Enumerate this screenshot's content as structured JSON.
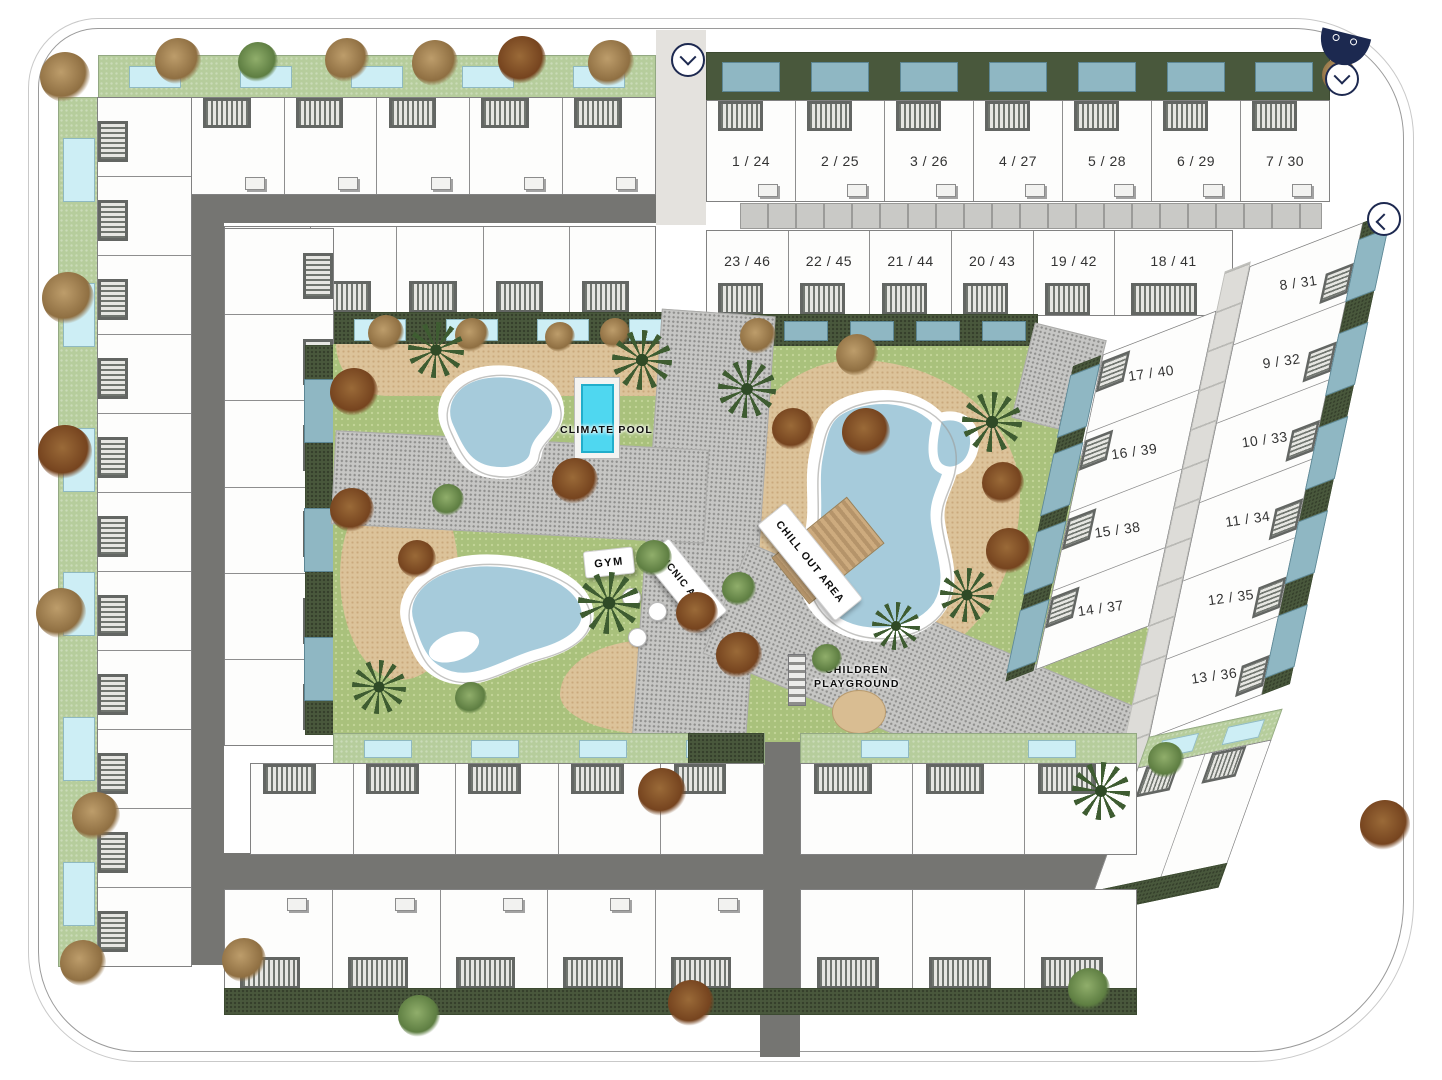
{
  "colors": {
    "navy": "#1d2950",
    "road": "#757572",
    "hedge_green": "#49583c",
    "lawn_green": "#b6cd9c",
    "amenity_grass": "#a9c17c",
    "sand": "#dcc39a",
    "lagoon_water": "#a6cbdb",
    "private_pool": "#cdeef5",
    "slate_pool": "#8fb7c3",
    "climate_pool": "#4fd7f0"
  },
  "units": {
    "row_top": [
      "1 / 24",
      "2 / 25",
      "3 / 26",
      "4 / 27",
      "5 / 28",
      "6 / 29",
      "7 / 30"
    ],
    "row_second": [
      "23 / 46",
      "22 / 45",
      "21 / 44",
      "20 / 43",
      "19 / 42",
      "18 / 41"
    ],
    "right_outer": [
      "8 / 31",
      "9 / 32",
      "10 / 33",
      "11 / 34",
      "12 / 35",
      "13 / 36"
    ],
    "right_inner": [
      "17 / 40",
      "16 / 39",
      "15 / 38",
      "14 / 37"
    ]
  },
  "labels": {
    "climate_pool": "CLIMATE POOL",
    "gym": "GYM",
    "picnic_area": "PICNIC AREA",
    "chill_out_area": "CHILL OUT AREA",
    "children_line1": "CHILDREN",
    "children_line2": "PLAYGROUND"
  },
  "plain_blocks": {
    "top_left_row1": 6,
    "top_left_row2": 5,
    "left_col_a": 11,
    "left_col_b": 6,
    "row_c_left": 5,
    "row_c_right": 3,
    "row_d_left": 5,
    "row_d_right": 3,
    "corner_cells": 2
  },
  "garden_pools": {
    "g1": 5,
    "g2": 7,
    "g3": 5,
    "left_strip": 6,
    "h1": 4,
    "hedge_b": 3,
    "g4_left": 4,
    "g4_right": 2,
    "diag_inner": 4,
    "diag_outer": 5,
    "corner": 2
  },
  "entrances": [
    {
      "dir": "down"
    },
    {
      "dir": "down"
    },
    {
      "dir": "left"
    }
  ],
  "decor": {
    "trees": [
      {
        "x": 155,
        "y": 38,
        "t": "t",
        "s": 46
      },
      {
        "x": 238,
        "y": 42,
        "t": "g",
        "s": 40
      },
      {
        "x": 325,
        "y": 38,
        "t": "t",
        "s": 44
      },
      {
        "x": 412,
        "y": 40,
        "t": "t",
        "s": 46
      },
      {
        "x": 498,
        "y": 36,
        "t": "r",
        "s": 48
      },
      {
        "x": 588,
        "y": 40,
        "t": "t",
        "s": 46
      },
      {
        "x": 40,
        "y": 52,
        "t": "t",
        "s": 50
      },
      {
        "x": 42,
        "y": 272,
        "t": "t",
        "s": 52
      },
      {
        "x": 38,
        "y": 425,
        "t": "r",
        "s": 54
      },
      {
        "x": 36,
        "y": 588,
        "t": "t",
        "s": 50
      },
      {
        "x": 72,
        "y": 792,
        "t": "t",
        "s": 48
      },
      {
        "x": 60,
        "y": 940,
        "t": "t",
        "s": 46
      },
      {
        "x": 368,
        "y": 315,
        "t": "t",
        "s": 36
      },
      {
        "x": 455,
        "y": 318,
        "t": "t",
        "s": 34
      },
      {
        "x": 545,
        "y": 322,
        "t": "t",
        "s": 30
      },
      {
        "x": 600,
        "y": 318,
        "t": "t",
        "s": 30
      },
      {
        "x": 740,
        "y": 318,
        "t": "t",
        "s": 36
      },
      {
        "x": 836,
        "y": 334,
        "t": "t",
        "s": 42
      },
      {
        "x": 330,
        "y": 368,
        "t": "r",
        "s": 48
      },
      {
        "x": 408,
        "y": 322,
        "t": "p",
        "s": 56
      },
      {
        "x": 612,
        "y": 330,
        "t": "p",
        "s": 60
      },
      {
        "x": 552,
        "y": 458,
        "t": "r",
        "s": 46
      },
      {
        "x": 330,
        "y": 488,
        "t": "r",
        "s": 44
      },
      {
        "x": 398,
        "y": 540,
        "t": "r",
        "s": 38
      },
      {
        "x": 432,
        "y": 484,
        "t": "g",
        "s": 32
      },
      {
        "x": 578,
        "y": 572,
        "t": "p",
        "s": 62
      },
      {
        "x": 636,
        "y": 540,
        "t": "g",
        "s": 36
      },
      {
        "x": 676,
        "y": 592,
        "t": "r",
        "s": 42
      },
      {
        "x": 716,
        "y": 632,
        "t": "r",
        "s": 46
      },
      {
        "x": 352,
        "y": 660,
        "t": "p",
        "s": 54
      },
      {
        "x": 455,
        "y": 682,
        "t": "g",
        "s": 32
      },
      {
        "x": 718,
        "y": 360,
        "t": "p",
        "s": 58
      },
      {
        "x": 772,
        "y": 408,
        "t": "r",
        "s": 42
      },
      {
        "x": 842,
        "y": 408,
        "t": "r",
        "s": 48
      },
      {
        "x": 962,
        "y": 392,
        "t": "p",
        "s": 60
      },
      {
        "x": 982,
        "y": 462,
        "t": "r",
        "s": 42
      },
      {
        "x": 986,
        "y": 528,
        "t": "r",
        "s": 46
      },
      {
        "x": 940,
        "y": 568,
        "t": "p",
        "s": 54
      },
      {
        "x": 872,
        "y": 602,
        "t": "p",
        "s": 48
      },
      {
        "x": 812,
        "y": 644,
        "t": "g",
        "s": 30
      },
      {
        "x": 722,
        "y": 572,
        "t": "g",
        "s": 34
      },
      {
        "x": 638,
        "y": 768,
        "t": "r",
        "s": 48
      },
      {
        "x": 1072,
        "y": 762,
        "t": "p",
        "s": 58
      },
      {
        "x": 668,
        "y": 980,
        "t": "r",
        "s": 46
      },
      {
        "x": 398,
        "y": 995,
        "t": "g",
        "s": 42
      },
      {
        "x": 222,
        "y": 938,
        "t": "t",
        "s": 44
      },
      {
        "x": 1068,
        "y": 968,
        "t": "g",
        "s": 42
      },
      {
        "x": 1360,
        "y": 800,
        "t": "r",
        "s": 50
      },
      {
        "x": 1322,
        "y": 58,
        "t": "t",
        "s": 34
      },
      {
        "x": 1148,
        "y": 742,
        "t": "g",
        "s": 36
      }
    ]
  }
}
